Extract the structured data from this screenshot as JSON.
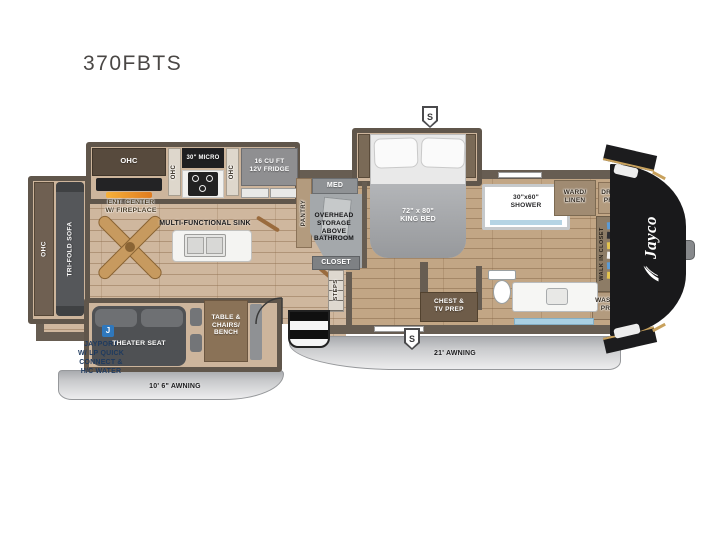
{
  "model": "370FBTS",
  "slide_marker": "S",
  "brand_logo": "Jayco",
  "exterior": {
    "awning_left": "10' 6\" AWNING",
    "awning_right": "21' AWNING",
    "jayport_icon": "J",
    "jayport_note": "JAYPORT\nW/ LP QUICK\nCONNECT &\nH/C WATER"
  },
  "living": {
    "ohc_sofa": "OHC",
    "tri_fold_sofa": "TRI-FOLD SOFA",
    "ent_center": "ENT. CENTER\nW/ FIREPLACE",
    "ohc_entertainment": "OHC",
    "ohc_micro_left": "OHC",
    "micro": "30\" MICRO",
    "ohc_micro_right": "OHC",
    "fridge": "16 CU FT\n12V FRIDGE",
    "multi_functional_sink": "MULTI-FUNCTIONAL SINK",
    "theater_seat": "THEATER SEAT",
    "table_chairs_bench": "TABLE &\nCHAIRS/\nBENCH"
  },
  "mid_bath": {
    "pantry": "PANTRY",
    "med": "MED",
    "overhead_storage": "OVERHEAD\nSTORAGE\nABOVE\nBATHROOM",
    "closet": "CLOSET",
    "steps": "STEPS"
  },
  "front": {
    "king_bed": "72\" x 80\"\nKING BED",
    "shower": "30\"x60\"\nSHOWER",
    "ward_linen": "WARD/\nLINEN",
    "dryer_prep": "DRYER\nPREP",
    "walk_in_closet": "WALK IN CLOSET",
    "washer_prep": "WASHER\nPREP",
    "chest_tv_prep": "CHEST &\nTV PREP"
  },
  "colors": {
    "floor_living": "#cfb79e",
    "floor_front": "#c2a685",
    "wall": "#675d52",
    "cabinet_brown": "#6f6052",
    "tan_cabinet": "#b39b7e",
    "cap_black": "#19191b",
    "awning_gray": "#d6d7d9",
    "jayport_blue": "#2f78bd",
    "fireplace_orange": "#f29124"
  }
}
